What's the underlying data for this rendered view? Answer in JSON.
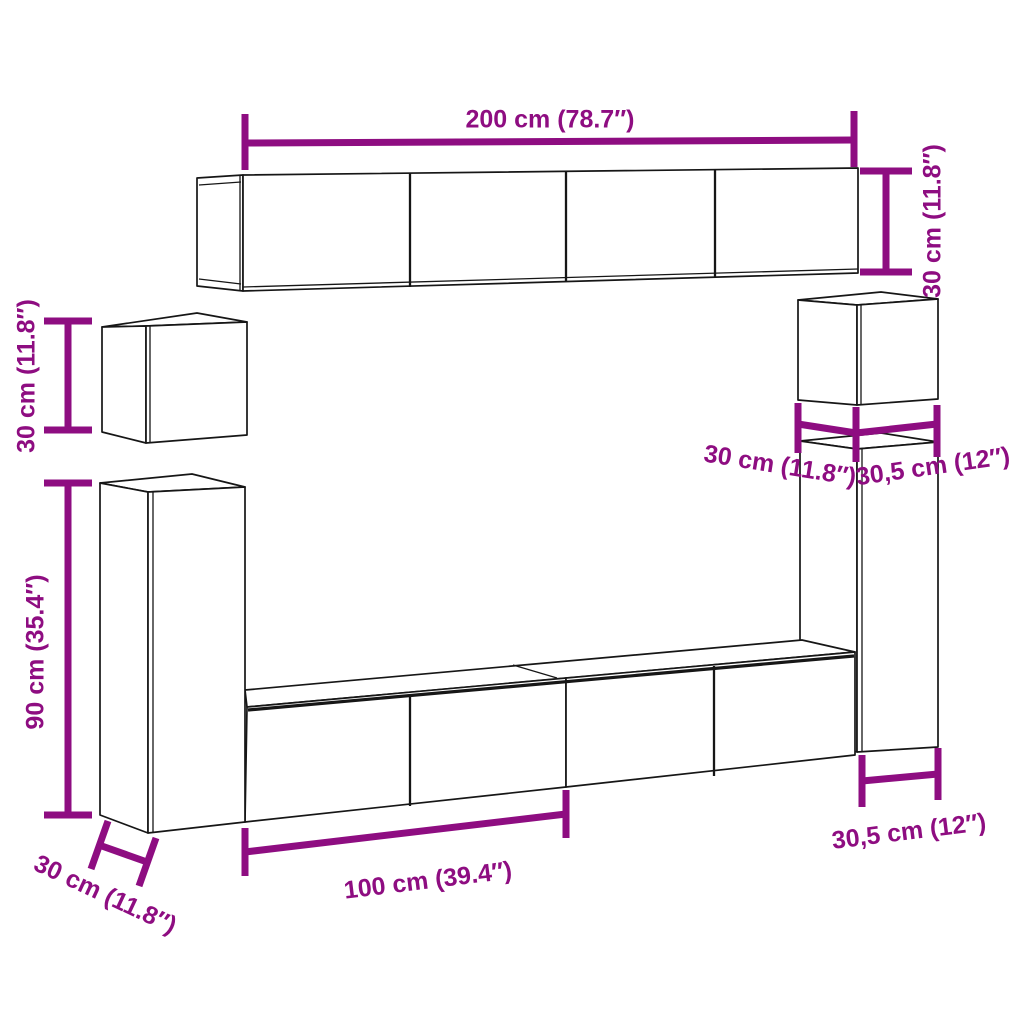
{
  "title": "Wall-mounted cabinet set dimension diagram",
  "colors": {
    "dimension": "#8e0d81",
    "outline": "#161616",
    "background": "#ffffff"
  },
  "labels": {
    "top_cabinet_width": "200 cm (78.7″)",
    "top_cabinet_height": "30 cm (11.8″)",
    "left_cube_height": "30 cm (11.8″)",
    "left_tall_height": "90 cm (35.4″)",
    "left_tall_depth": "30 cm (11.8″)",
    "bottom_cabinet_width": "100 cm (39.4″)",
    "right_cube_depth": "30 cm (11.8″)",
    "right_cube_width": "30,5 cm (12″)",
    "right_tall_width": "30,5 cm (12″)"
  }
}
